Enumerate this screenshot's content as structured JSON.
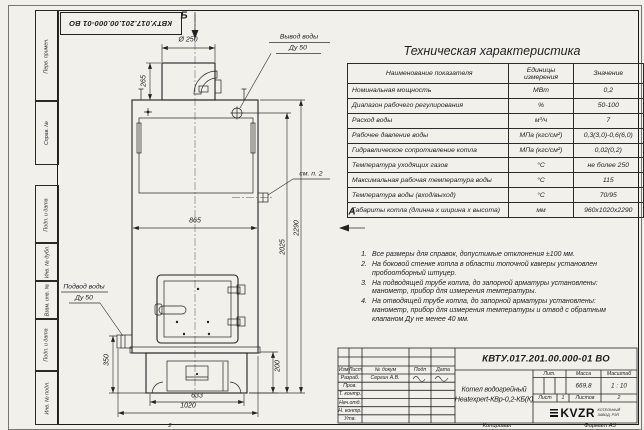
{
  "sheet": {
    "doc_number": "КВТУ.017.201.00.000-01 ВО",
    "fold_mark": "2",
    "footer": {
      "copied": "Копировал",
      "format": "Формат А3"
    },
    "margin_labels": [
      "Перв. примен.",
      "Справ. №",
      "Подп. и дата",
      "Инв. № дубл.",
      "Взам. инв. №",
      "Подп. и дата",
      "Инв. № подл."
    ]
  },
  "drawing": {
    "view_b": "Б",
    "view_a": "А",
    "see_note": "см. п. 2",
    "outlet_1": "Вывод воды",
    "outlet_2": "Ду 50",
    "inlet_1": "Подвод воды",
    "inlet_2": "Ду 50",
    "dims": {
      "chimney_dia": "Ø 250",
      "chimney_h": "265",
      "body_w": "865",
      "base_w": "633",
      "overall_w": "1020",
      "inlet_h": "350",
      "base_h": "200",
      "mid_h": "2025",
      "total_h": "2290"
    }
  },
  "spec": {
    "title": "Техническая характеристика",
    "columns": [
      "Наименование показателя",
      "Единицы измерения",
      "Значение"
    ],
    "rows": [
      {
        "name": "Номинальная мощность",
        "unit": "МВт",
        "value": "0,2"
      },
      {
        "name": "Диапазон рабочего регулирования",
        "unit": "%",
        "value": "50-100"
      },
      {
        "name": "Расход воды",
        "unit": "м³/ч",
        "value": "7"
      },
      {
        "name": "Рабочее давление воды",
        "unit": "МПа (кгс/см²)",
        "value": "0,3(3,0)-0,6(6,0)"
      },
      {
        "name": "Гидравлическое сопротивление котла",
        "unit": "МПа (кгс/см²)",
        "value": "0,02(0,2)"
      },
      {
        "name": "Температура уходящих газов",
        "unit": "°С",
        "value": "не более 250"
      },
      {
        "name": "Максимальная рабочая температура воды",
        "unit": "°С",
        "value": "115"
      },
      {
        "name": "Температура воды (вход/выход)",
        "unit": "°С",
        "value": "70/95"
      },
      {
        "name": "Габариты котла (длинна х ширина х высота)",
        "unit": "мм",
        "value": "960х1020х2290"
      }
    ]
  },
  "notes": [
    {
      "n": "1.",
      "text": "Все размеры для справок, допустимые отклонения ±100 мм."
    },
    {
      "n": "2.",
      "text": "На боковой стенке котла в области топочной камеры установлен пробоотборный штуцер."
    },
    {
      "n": "3.",
      "text": "На подводящей трубе котла, до запорной арматуры установлены: манометр, прибор для измерения температуры."
    },
    {
      "n": "4.",
      "text": "На отводящей трубе котла, до запорной арматуры установлены: манометр, прибор для измерения температуры и отвод с обратным клапаном Ду не менее 40 мм."
    }
  ],
  "title_block": {
    "header_cells": [
      "Изм",
      "Лист",
      "№ докум",
      "Подп",
      "Дата"
    ],
    "rows": [
      {
        "label": "Разраб.",
        "name": "Сергин А.В."
      },
      {
        "label": "Пров."
      },
      {
        "label": "Т. контр."
      },
      {
        "label": "Нач.отд."
      },
      {
        "label": "Н. контр."
      },
      {
        "label": "Утв."
      }
    ],
    "product_1": "Котел водогрейный",
    "product_2": "Heatexpert-КВр-0,2-КБ(К)",
    "lit_label": "Лит.",
    "mass_label": "Масса",
    "scale_label": "Масштаб",
    "mass": "669,8",
    "scale": "1 : 10",
    "sheet_label": "Лист",
    "sheet_num": "1",
    "sheets_label": "Листов",
    "sheets_num": "2",
    "logo_text": "KVZR",
    "logo_sub_1": "КОТЕЛЬНЫЙ",
    "logo_sub_2": "ЗАВОД, РЭП"
  }
}
